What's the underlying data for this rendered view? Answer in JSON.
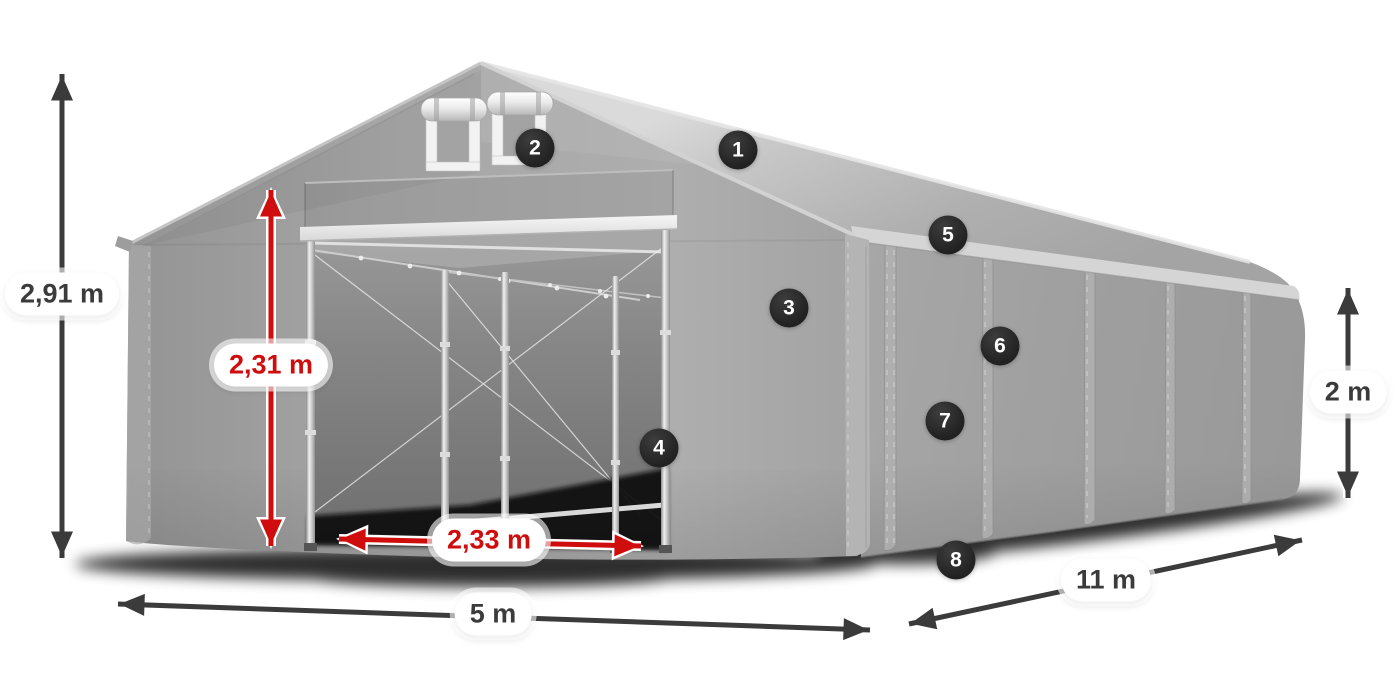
{
  "colors": {
    "dimension_dark": "#3b3b3b",
    "dimension_red": "#cf0d0d",
    "badge_background": "#242424",
    "badge_text": "#ffffff",
    "tent_roof_light": "#d2d2d2",
    "tent_fabric_mid": "#a5a5a5",
    "tent_fabric_dark": "#8f8f8f",
    "label_pill_background": "#ffffff"
  },
  "dimensions": {
    "total_height": {
      "value": "2,91 m",
      "accent": "dark"
    },
    "entrance_height": {
      "value": "2,31 m",
      "accent": "red"
    },
    "entrance_width": {
      "value": "2,33 m",
      "accent": "red"
    },
    "front_width": {
      "value": "5 m",
      "accent": "dark"
    },
    "side_length": {
      "value": "11 m",
      "accent": "dark"
    },
    "side_height": {
      "value": "2 m",
      "accent": "dark"
    }
  },
  "callouts": [
    {
      "number": "1"
    },
    {
      "number": "2"
    },
    {
      "number": "3"
    },
    {
      "number": "4"
    },
    {
      "number": "5"
    },
    {
      "number": "6"
    },
    {
      "number": "7"
    },
    {
      "number": "8"
    }
  ]
}
